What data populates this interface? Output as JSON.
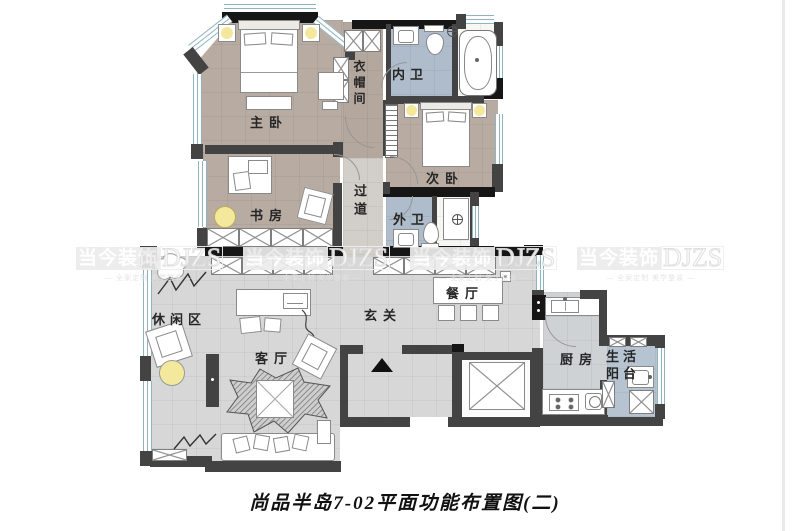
{
  "page": {
    "caption": "尚品半岛7-02平面功能布置图(二)"
  },
  "watermark": {
    "brand": "当今装饰",
    "code": "DJZS",
    "tagline": "— 全案定制 美学整装 —"
  },
  "rooms": {
    "master_bedroom": "主卧",
    "study": "书房",
    "cloakroom": "衣帽间",
    "inner_bathroom": "内卫",
    "second_bedroom": "次卧",
    "corridor": "过道",
    "outer_bathroom": "外卫",
    "leisure_area": "休闲区",
    "living_room": "客厅",
    "foyer": "玄关",
    "dining_room": "餐厅",
    "kitchen": "厨房",
    "utility_balcony": "生活阳台"
  },
  "colors": {
    "wall": "#434343",
    "wall_black": "#161616",
    "bedroom_floor": "#b7aba2",
    "bath_floor": "#aebccb",
    "living_floor": "#d7d7d7",
    "kitchen_floor": "#ced2d5",
    "balcony_floor": "#b6c4d1",
    "corridor_floor": "#d2cfca",
    "lamp_accent": "#f3e89c",
    "window_line": "#8fb4c0"
  }
}
